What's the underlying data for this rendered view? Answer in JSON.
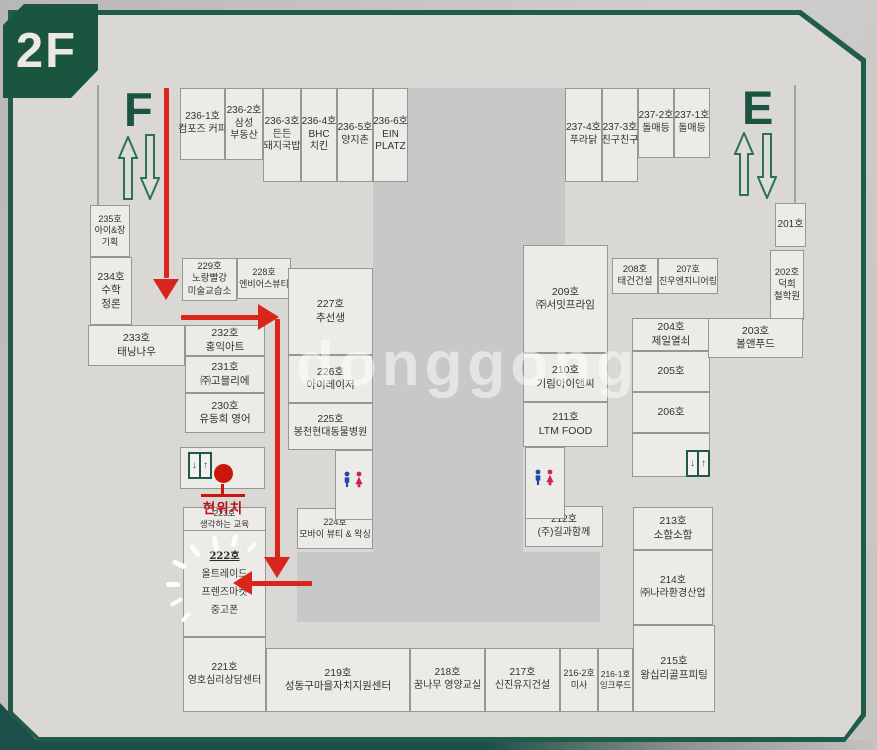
{
  "floor_label": "2F",
  "watermark": "donggong",
  "stairs": {
    "left": "F",
    "right": "E"
  },
  "current_location_label": "현위치",
  "colors": {
    "frame_green": "#215c4a",
    "route_red": "#d8261d",
    "board": "#dad8d5",
    "room_fill": "#edebe8",
    "courtyard": "#c7c9c8",
    "toilet_male": "#1c49a8",
    "toilet_female": "#cf2257"
  },
  "map": {
    "rooms": [
      {
        "id": "236-1",
        "lines": [
          "236-1호",
          "컴포즈 커피"
        ],
        "x": 180,
        "y": 88,
        "w": 45,
        "h": 72,
        "fs": 10
      },
      {
        "id": "236-2",
        "lines": [
          "236-2호",
          "삼성",
          "부동산"
        ],
        "x": 225,
        "y": 88,
        "w": 38,
        "h": 72,
        "fs": 10
      },
      {
        "id": "236-3",
        "lines": [
          "236-3호",
          "든든",
          "돼지국밥"
        ],
        "x": 263,
        "y": 88,
        "w": 38,
        "h": 94,
        "fs": 10
      },
      {
        "id": "236-4",
        "lines": [
          "236-4호",
          "BHC",
          "치킨"
        ],
        "x": 301,
        "y": 88,
        "w": 36,
        "h": 94,
        "fs": 10
      },
      {
        "id": "236-5",
        "lines": [
          "236-5호",
          "양지촌"
        ],
        "x": 337,
        "y": 88,
        "w": 36,
        "h": 94,
        "fs": 10
      },
      {
        "id": "236-6",
        "lines": [
          "236-6호",
          "EIN",
          "PLATZ"
        ],
        "x": 373,
        "y": 88,
        "w": 35,
        "h": 94,
        "fs": 10
      },
      {
        "id": "237-4",
        "lines": [
          "237-4호",
          "푸라닭"
        ],
        "x": 565,
        "y": 88,
        "w": 37,
        "h": 94,
        "fs": 10
      },
      {
        "id": "237-3",
        "lines": [
          "237-3호",
          "친구친구"
        ],
        "x": 602,
        "y": 88,
        "w": 36,
        "h": 94,
        "fs": 10
      },
      {
        "id": "237-2",
        "lines": [
          "237-2호",
          "돌매등"
        ],
        "x": 638,
        "y": 88,
        "w": 36,
        "h": 70,
        "fs": 10
      },
      {
        "id": "237-1",
        "lines": [
          "237-1호",
          "돌매등"
        ],
        "x": 674,
        "y": 88,
        "w": 36,
        "h": 70,
        "fs": 10
      },
      {
        "id": "235",
        "lines": [
          "235호",
          "아이&장",
          "기획"
        ],
        "x": 90,
        "y": 205,
        "w": 40,
        "h": 52,
        "fs": 9
      },
      {
        "id": "234",
        "lines": [
          "234호",
          "수학",
          "정론"
        ],
        "x": 90,
        "y": 257,
        "w": 42,
        "h": 68,
        "fs": 10.5
      },
      {
        "id": "233",
        "lines": [
          "233호",
          "태닝나우"
        ],
        "x": 88,
        "y": 325,
        "w": 97,
        "h": 41,
        "fs": 10.5
      },
      {
        "id": "229",
        "lines": [
          "229호",
          "노랑빨강",
          "미술교습소"
        ],
        "x": 182,
        "y": 258,
        "w": 55,
        "h": 43,
        "fs": 9.5
      },
      {
        "id": "228",
        "lines": [
          "228호",
          "엔비어스뷰티"
        ],
        "x": 237,
        "y": 258,
        "w": 54,
        "h": 41,
        "fs": 9
      },
      {
        "id": "232",
        "lines": [
          "232호",
          "홍익아트"
        ],
        "x": 185,
        "y": 325,
        "w": 80,
        "h": 31,
        "fs": 10.5
      },
      {
        "id": "231",
        "lines": [
          "231호",
          "㈜고믈리에"
        ],
        "x": 185,
        "y": 356,
        "w": 80,
        "h": 37,
        "fs": 10.5
      },
      {
        "id": "230",
        "lines": [
          "230호",
          "유동희 영어"
        ],
        "x": 185,
        "y": 393,
        "w": 80,
        "h": 40,
        "fs": 10.5
      },
      {
        "id": "223",
        "lines": [
          "223호",
          "생각하는 교육"
        ],
        "x": 183,
        "y": 507,
        "w": 83,
        "h": 24,
        "fs": 8.5
      },
      {
        "id": "222",
        "lines": [
          "222호",
          "올트레이드",
          "프렌즈마켓",
          "중고폰"
        ],
        "x": 183,
        "y": 530,
        "w": 83,
        "h": 107,
        "fs": 10,
        "cls": "hand"
      },
      {
        "id": "221",
        "lines": [
          "221호",
          "영호심리상담센터"
        ],
        "x": 183,
        "y": 637,
        "w": 83,
        "h": 75,
        "fs": 10
      },
      {
        "id": "227",
        "lines": [
          "227호",
          "추선생"
        ],
        "x": 288,
        "y": 268,
        "w": 85,
        "h": 87,
        "fs": 10.5
      },
      {
        "id": "226",
        "lines": [
          "226호",
          "아이레이저"
        ],
        "x": 288,
        "y": 355,
        "w": 85,
        "h": 48,
        "fs": 10.5
      },
      {
        "id": "225",
        "lines": [
          "225호",
          "봉천현대동물병원"
        ],
        "x": 288,
        "y": 403,
        "w": 85,
        "h": 47,
        "fs": 10
      },
      {
        "id": "224",
        "lines": [
          "224호",
          "모바이 뷰티 & 왁싱"
        ],
        "x": 297,
        "y": 508,
        "w": 76,
        "h": 41,
        "fs": 9
      },
      {
        "id": "209",
        "lines": [
          "209호",
          "㈜서밋프라임"
        ],
        "x": 523,
        "y": 245,
        "w": 85,
        "h": 108,
        "fs": 10.5
      },
      {
        "id": "210",
        "lines": [
          "210호",
          "기림아이앤씨"
        ],
        "x": 523,
        "y": 353,
        "w": 85,
        "h": 49,
        "fs": 10.5
      },
      {
        "id": "211",
        "lines": [
          "211호",
          "LTM FOOD"
        ],
        "x": 523,
        "y": 402,
        "w": 85,
        "h": 45,
        "fs": 10.5
      },
      {
        "id": "212",
        "lines": [
          "212호",
          "(주)길과함께"
        ],
        "x": 525,
        "y": 506,
        "w": 78,
        "h": 41,
        "fs": 10
      },
      {
        "id": "208",
        "lines": [
          "208호",
          "태건건설"
        ],
        "x": 612,
        "y": 258,
        "w": 46,
        "h": 36,
        "fs": 9.5
      },
      {
        "id": "207",
        "lines": [
          "207호",
          "진우엔지니어링"
        ],
        "x": 658,
        "y": 258,
        "w": 60,
        "h": 36,
        "fs": 9
      },
      {
        "id": "204",
        "lines": [
          "204호",
          "제일열쇠"
        ],
        "x": 632,
        "y": 318,
        "w": 78,
        "h": 33,
        "fs": 10.5
      },
      {
        "id": "205",
        "lines": [
          "205호"
        ],
        "x": 632,
        "y": 351,
        "w": 78,
        "h": 41,
        "fs": 10.5
      },
      {
        "id": "206",
        "lines": [
          "206호"
        ],
        "x": 632,
        "y": 392,
        "w": 78,
        "h": 41,
        "fs": 10.5
      },
      {
        "id": "213",
        "lines": [
          "213호",
          "소함소함"
        ],
        "x": 633,
        "y": 507,
        "w": 80,
        "h": 43,
        "fs": 10.5
      },
      {
        "id": "214",
        "lines": [
          "214호",
          "㈜나라환경산업"
        ],
        "x": 633,
        "y": 550,
        "w": 80,
        "h": 75,
        "fs": 10
      },
      {
        "id": "215",
        "lines": [
          "215호",
          "왕십리골프피팅"
        ],
        "x": 633,
        "y": 625,
        "w": 82,
        "h": 87,
        "fs": 10.5
      },
      {
        "id": "201",
        "lines": [
          "201호"
        ],
        "x": 775,
        "y": 203,
        "w": 31,
        "h": 44,
        "fs": 10
      },
      {
        "id": "202",
        "lines": [
          "202호",
          "덕희",
          "철학원"
        ],
        "x": 770,
        "y": 250,
        "w": 34,
        "h": 70,
        "fs": 9.5
      },
      {
        "id": "203",
        "lines": [
          "203호",
          "볼앤푸드"
        ],
        "x": 708,
        "y": 318,
        "w": 95,
        "h": 40,
        "fs": 10.5
      },
      {
        "id": "219",
        "lines": [
          "219호",
          "성동구마을자치지원센터"
        ],
        "x": 266,
        "y": 648,
        "w": 144,
        "h": 64,
        "fs": 10.5
      },
      {
        "id": "218",
        "lines": [
          "218호",
          "꿈나무 영양교실"
        ],
        "x": 410,
        "y": 648,
        "w": 75,
        "h": 64,
        "fs": 10
      },
      {
        "id": "217",
        "lines": [
          "217호",
          "신진유지건설"
        ],
        "x": 485,
        "y": 648,
        "w": 75,
        "h": 64,
        "fs": 10
      },
      {
        "id": "216-2",
        "lines": [
          "216-2호",
          "미사"
        ],
        "x": 560,
        "y": 648,
        "w": 38,
        "h": 64,
        "fs": 9
      },
      {
        "id": "216-1",
        "lines": [
          "216-1호",
          "잉크루드"
        ],
        "x": 598,
        "y": 648,
        "w": 35,
        "h": 64,
        "fs": 8.5
      },
      {
        "id": "elevator-zone-left",
        "lines": [],
        "x": 180,
        "y": 447,
        "w": 85,
        "h": 42
      },
      {
        "id": "wc-zone-left",
        "lines": [],
        "x": 335,
        "y": 450,
        "w": 38,
        "h": 70
      },
      {
        "id": "wc-zone-right",
        "lines": [],
        "x": 525,
        "y": 447,
        "w": 40,
        "h": 72
      },
      {
        "id": "elevator-zone-right",
        "lines": [],
        "x": 632,
        "y": 433,
        "w": 78,
        "h": 44
      }
    ],
    "courtyards": [
      {
        "x": 408,
        "y": 88,
        "w": 157,
        "h": 157
      },
      {
        "x": 373,
        "y": 182,
        "w": 150,
        "h": 378
      },
      {
        "x": 297,
        "y": 552,
        "w": 303,
        "h": 70
      }
    ],
    "walls": [
      {
        "x": 97,
        "y": 85,
        "w": 2,
        "h": 120
      },
      {
        "x": 794,
        "y": 85,
        "w": 2,
        "h": 120
      },
      {
        "x": 336,
        "y": 462,
        "w": 16,
        "h": 1
      },
      {
        "x": 336,
        "y": 498,
        "w": 16,
        "h": 1
      },
      {
        "x": 526,
        "y": 460,
        "w": 16,
        "h": 1
      },
      {
        "x": 526,
        "y": 496,
        "w": 16,
        "h": 1
      }
    ],
    "route": {
      "segments": [
        {
          "x": 164,
          "y": 88,
          "w": 5,
          "h": 190
        },
        {
          "x": 181,
          "y": 315,
          "w": 78,
          "h": 5
        },
        {
          "x": 275,
          "y": 319,
          "w": 5,
          "h": 240
        },
        {
          "x": 252,
          "y": 581,
          "w": 60,
          "h": 5
        }
      ],
      "arrowheads": [
        {
          "dir": "down",
          "x": 153,
          "y": 279
        },
        {
          "dir": "right",
          "x": 258,
          "y": 304
        },
        {
          "dir": "down",
          "x": 264,
          "y": 557
        },
        {
          "dir": "left",
          "x": 233,
          "y": 571
        }
      ]
    },
    "rays": [
      {
        "x": 208,
        "y": 541,
        "l": 15,
        "t": 5,
        "r": 80
      },
      {
        "x": 188,
        "y": 548,
        "l": 14,
        "t": 5,
        "r": 50
      },
      {
        "x": 172,
        "y": 562,
        "l": 15,
        "t": 5,
        "r": 25
      },
      {
        "x": 166,
        "y": 582,
        "l": 14,
        "t": 5,
        "r": 0
      },
      {
        "x": 170,
        "y": 600,
        "l": 13,
        "t": 4,
        "r": -30
      },
      {
        "x": 228,
        "y": 538,
        "l": 13,
        "t": 5,
        "r": 105
      },
      {
        "x": 246,
        "y": 545,
        "l": 12,
        "t": 4,
        "r": 135
      },
      {
        "x": 180,
        "y": 615,
        "l": 12,
        "t": 4,
        "r": -50
      }
    ],
    "facilities": {
      "elevators": [
        {
          "x": 188,
          "y": 452
        },
        {
          "x": 686,
          "y": 450
        }
      ],
      "toilets": [
        {
          "x": 342,
          "y": 471
        },
        {
          "x": 533,
          "y": 469
        }
      ]
    }
  }
}
